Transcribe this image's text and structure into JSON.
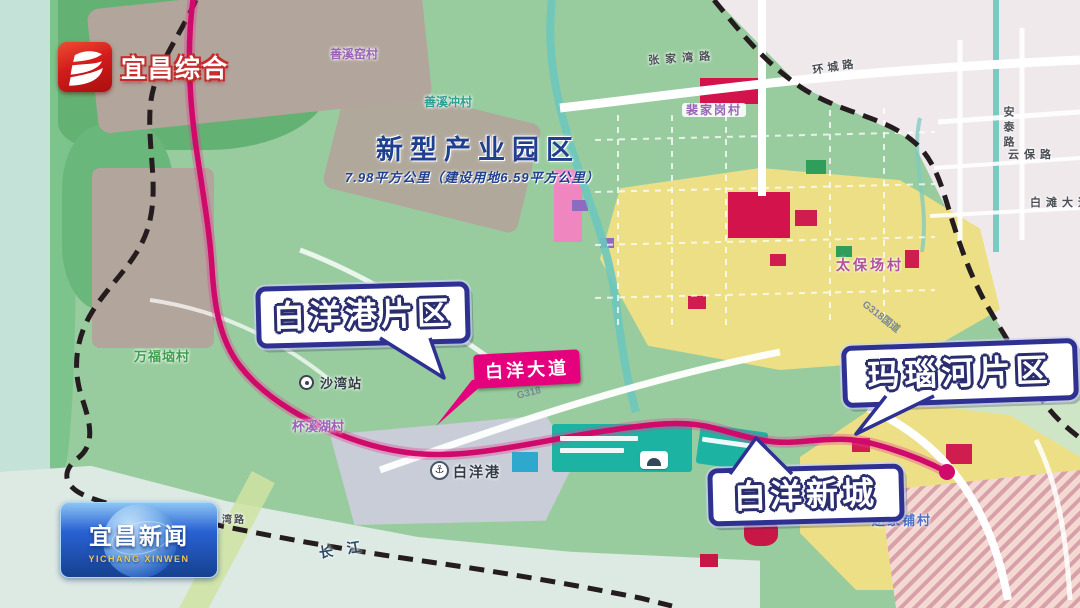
{
  "broadcast": {
    "channel": {
      "name": "宜昌综合"
    },
    "program": {
      "title": "宜昌新闻",
      "subtitle": "YICHANG XINWEN"
    }
  },
  "map": {
    "zone_title": {
      "text": "新型产业园区",
      "subtitle": "7.98平方公里（建设用地6.59平方公里）"
    },
    "callouts": {
      "baiyang_port": "白洋港片区",
      "manao_river": "玛瑙河片区",
      "baiyang_newtown": "白洋新城"
    },
    "road_badge": "白洋大道",
    "icons": {
      "port_anchor": "⚓"
    },
    "labels": [
      {
        "text": "善溪窑村",
        "x": 330,
        "y": 48,
        "cls": "lbl-purple",
        "size": 12
      },
      {
        "text": "善溪冲村",
        "x": 424,
        "y": 96,
        "cls": "lbl-teal",
        "size": 12
      },
      {
        "text": "张家湾路",
        "x": 648,
        "y": 56,
        "cls": "lbl-road",
        "size": 11,
        "ls": 6,
        "rot": -4
      },
      {
        "text": "环城路",
        "x": 812,
        "y": 66,
        "cls": "lbl-road",
        "size": 11,
        "ls": 4,
        "rot": -9
      },
      {
        "text": "裴家岗村",
        "x": 682,
        "y": 103,
        "cls": "lbl-purple chip",
        "size": 12,
        "ls": 2
      },
      {
        "text": "安泰路",
        "x": 1002,
        "y": 106,
        "cls": "lbl-road",
        "size": 11,
        "v": 1,
        "ls": 4
      },
      {
        "text": "云保路",
        "x": 1008,
        "y": 150,
        "cls": "lbl-road",
        "size": 11,
        "ls": 5
      },
      {
        "text": "白滩大道",
        "x": 1030,
        "y": 198,
        "cls": "lbl-road",
        "size": 11,
        "ls": 5
      },
      {
        "text": "太保场村",
        "x": 836,
        "y": 258,
        "cls": "lbl-village",
        "size": 14,
        "ls": 3
      },
      {
        "text": "万福垴村",
        "x": 134,
        "y": 350,
        "cls": "lbl-green",
        "size": 13,
        "ls": 1
      },
      {
        "text": "沙湾站",
        "x": 320,
        "y": 377,
        "cls": "lbl-dark",
        "size": 13,
        "ls": 1
      },
      {
        "text": "杯溪湖村",
        "x": 292,
        "y": 420,
        "cls": "lbl-purple",
        "size": 13
      },
      {
        "text": "白洋港",
        "x": 453,
        "y": 465,
        "cls": "lbl-dark",
        "size": 14,
        "ls": 2
      },
      {
        "text": "G318",
        "x": 516,
        "y": 392,
        "cls": "lbl-gray",
        "size": 10,
        "rot": -14
      },
      {
        "text": "G318国道",
        "x": 866,
        "y": 300,
        "cls": "lbl-gray",
        "size": 10,
        "rot": 38
      },
      {
        "text": "赵家铺村",
        "x": 872,
        "y": 514,
        "cls": "lbl-blue",
        "size": 13,
        "ls": 2
      },
      {
        "text": "湾路",
        "x": 222,
        "y": 516,
        "cls": "lbl-road",
        "size": 10,
        "ls": 2
      },
      {
        "text": "长江",
        "x": 318,
        "y": 546,
        "cls": "lbl-river",
        "size": 14,
        "ls": 14,
        "rot": -9
      }
    ]
  },
  "colors": {
    "route_magenta": "#cf0a6a",
    "boundary_dash": "#241c1e",
    "callout_border": "#2e3192",
    "road_badge_bg": "#e5007e",
    "zone_title_blue": "#20408f",
    "logo_red": "#d21c1c",
    "badge_blue": "#1d55c8",
    "badge_gold": "#f3c64a"
  }
}
